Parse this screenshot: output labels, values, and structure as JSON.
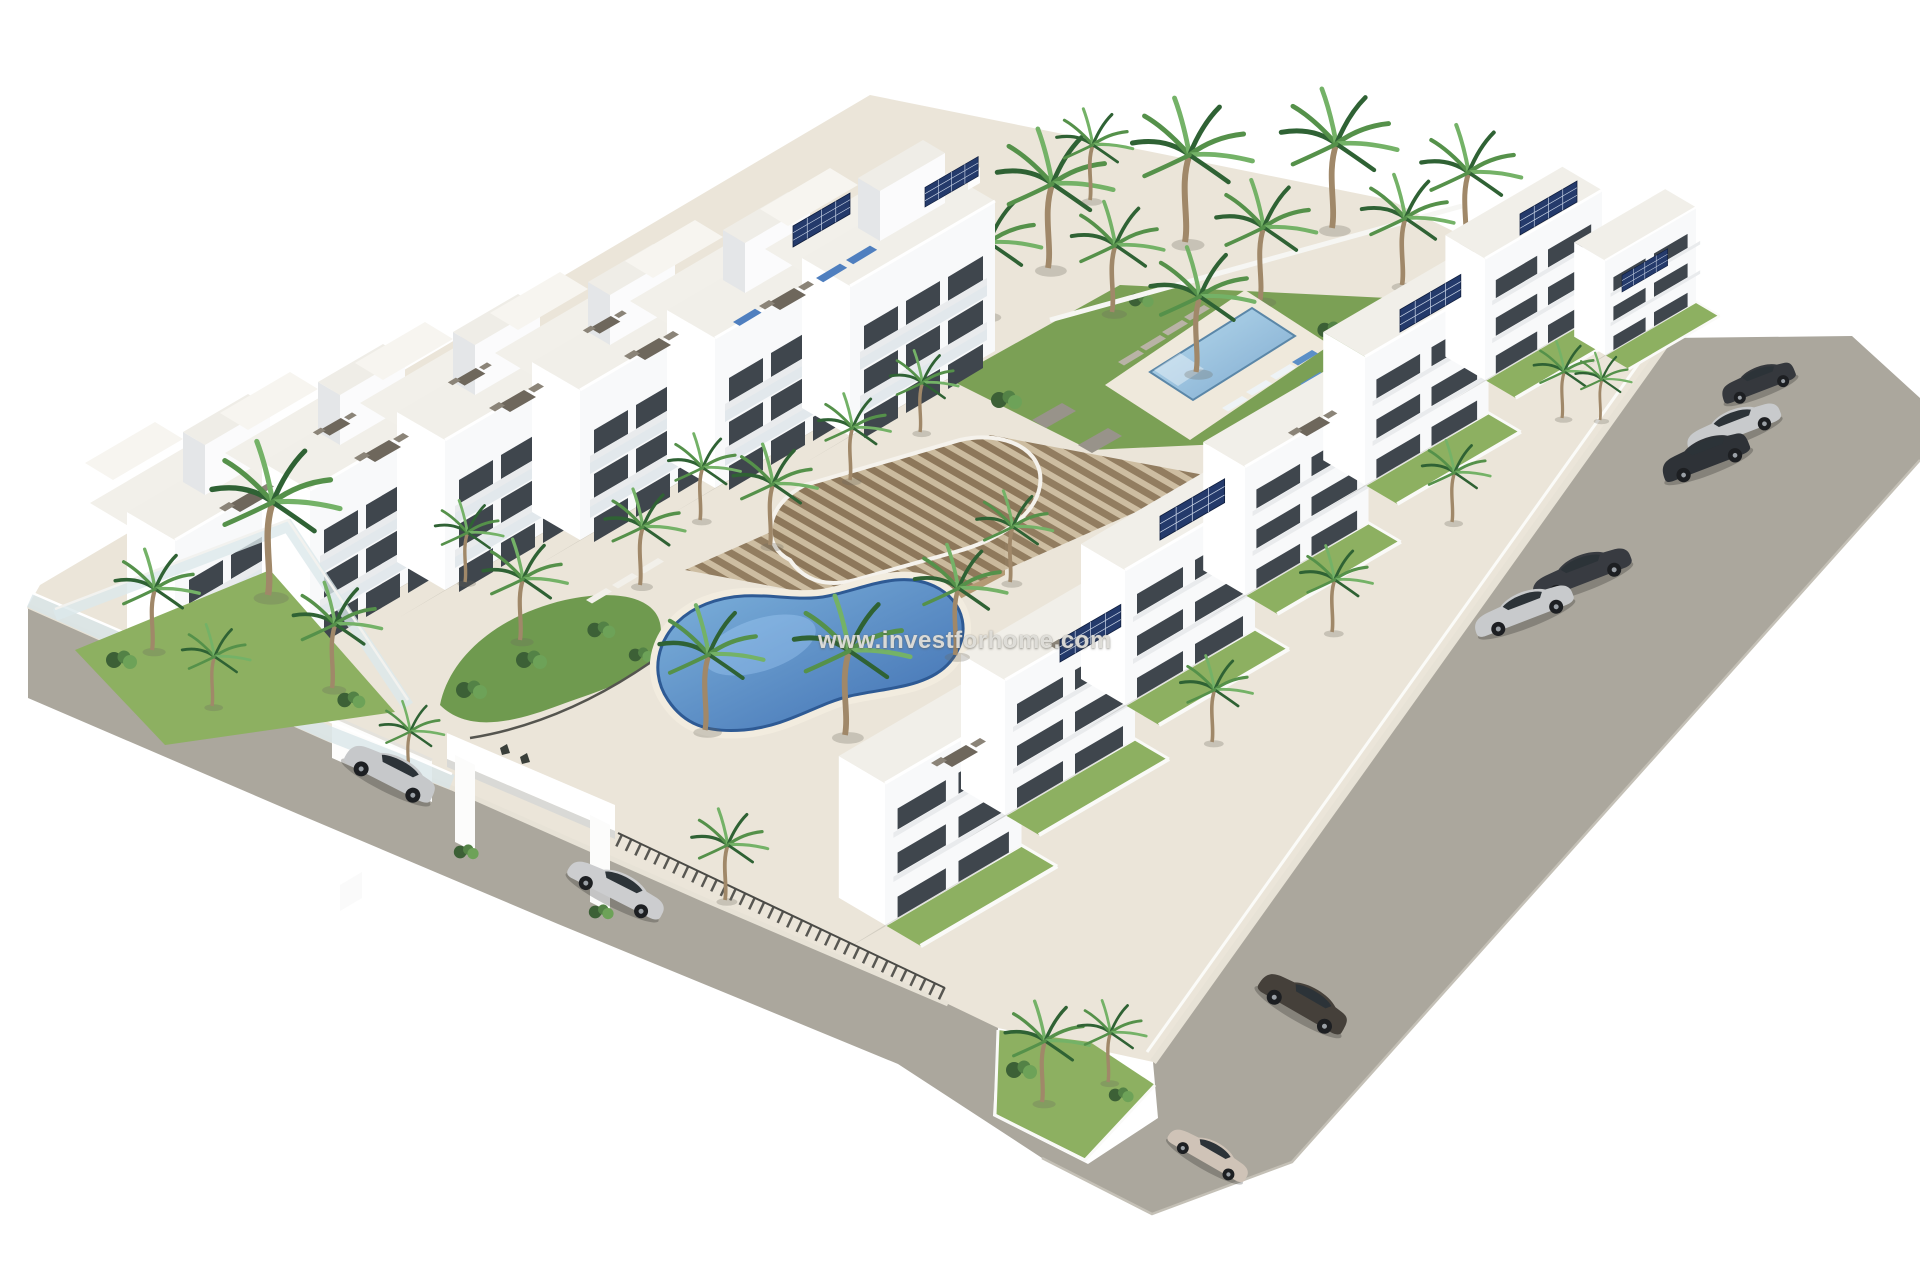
{
  "window": {
    "width": 1920,
    "height": 1280,
    "background": "#ffffff"
  },
  "watermark": {
    "text": "www.investforhome.com",
    "color": "#e9e8e4",
    "position": "center"
  },
  "palette": {
    "road": "#aba79d",
    "paving": "#ebe5d9",
    "building_white": "#f8f9fa",
    "building_shade": "#d9dbde",
    "window_glass": "#3f464d",
    "lawn": "#8db061",
    "garden": "#6f9a4f",
    "bush_dark": "#3c6036",
    "palm_frond": "#4e8a46",
    "palm_trunk": "#a08869",
    "pool_kidney": "#4d7fbe",
    "pool_rect": "#8fc3e0",
    "pergola_wood": "#8d775a",
    "solar_panel": "#243a6b",
    "car_silver": "#c8cacc",
    "car_dark": "#35383d",
    "car_brown": "#45403a",
    "car_beige": "#cfc3b7"
  },
  "scene": {
    "type": "aerial-3d-architectural-render",
    "subject": "white apartment complex with gardens, two pools, pergola, perimeter road and parked cars",
    "pools": [
      "kidney-pool",
      "rectangular-pool"
    ],
    "apartment_rows": {
      "west_blocks": 6,
      "east_blocks": 7
    },
    "parked_cars": 9,
    "entrance": "white-gate-portal",
    "vegetation": [
      "palm-trees",
      "bushes",
      "lawns"
    ]
  }
}
